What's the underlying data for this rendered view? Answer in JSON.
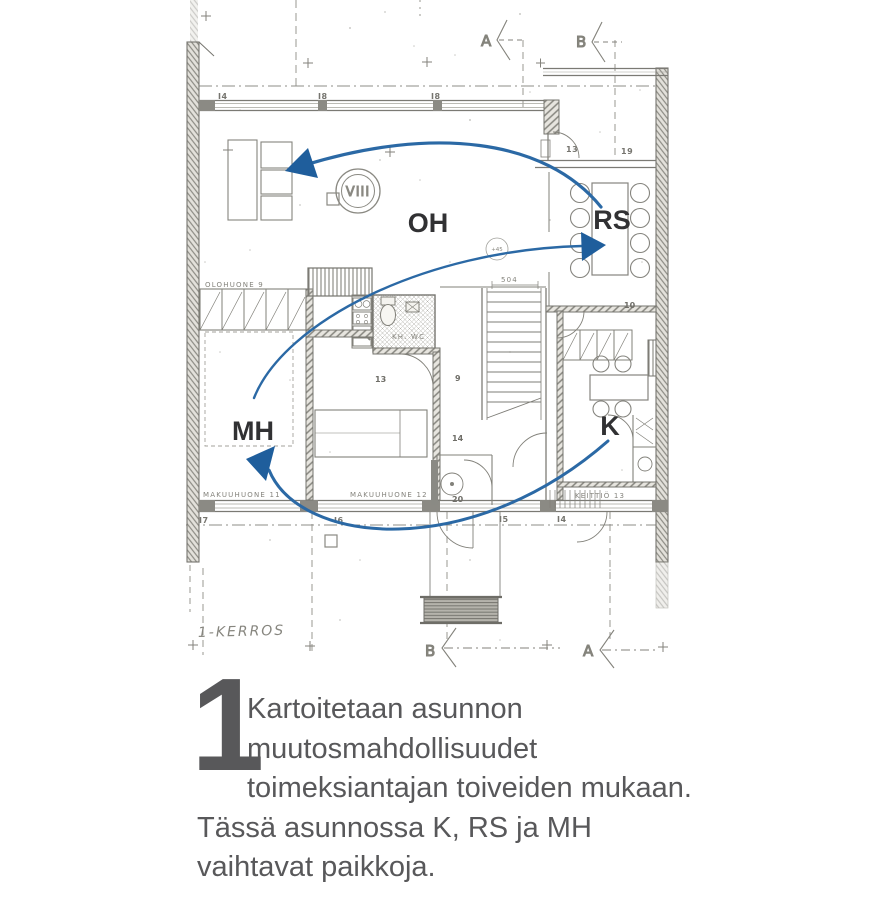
{
  "plan": {
    "room_labels": {
      "oh": "OH",
      "rs": "RS",
      "mh": "MH",
      "k": "K"
    },
    "section_markers": {
      "top_a": "A",
      "top_b": "B",
      "bottom_a": "A",
      "bottom_b": "B"
    },
    "floor_label": "1-KERROS",
    "stamp": "VIII",
    "arrow_color": "#2b69a5",
    "small_texts": {
      "olohuone": "OLOHUONE 9",
      "makuuhuone11": "MAKUUHUONE 11",
      "makuuhuone12": "MAKUUHUONE 12",
      "keittio": "KEITTIÖ 13",
      "khwc": "KH. WC",
      "dim504": "504",
      "lamp": "+45",
      "num9": "9",
      "num13": "13",
      "num14": "14",
      "num20": "20",
      "num10": "10",
      "win_i4": "I4",
      "win_i8a": "I8",
      "win_i8b": "I8",
      "win_13": "13",
      "win_19": "19",
      "win_i7": "I7",
      "win_i6": "I6",
      "win_i5": "I5",
      "win_i4b": "I4"
    }
  },
  "caption": {
    "number": "1",
    "line1": "Kartoitetaan asunnon",
    "line2": "muutosmahdollisuudet",
    "line3": "toimeksiantajan toiveiden mukaan.",
    "line4": "Tässä asunnossa K, RS ja MH",
    "line5": "vaihtavat paikkoja."
  }
}
